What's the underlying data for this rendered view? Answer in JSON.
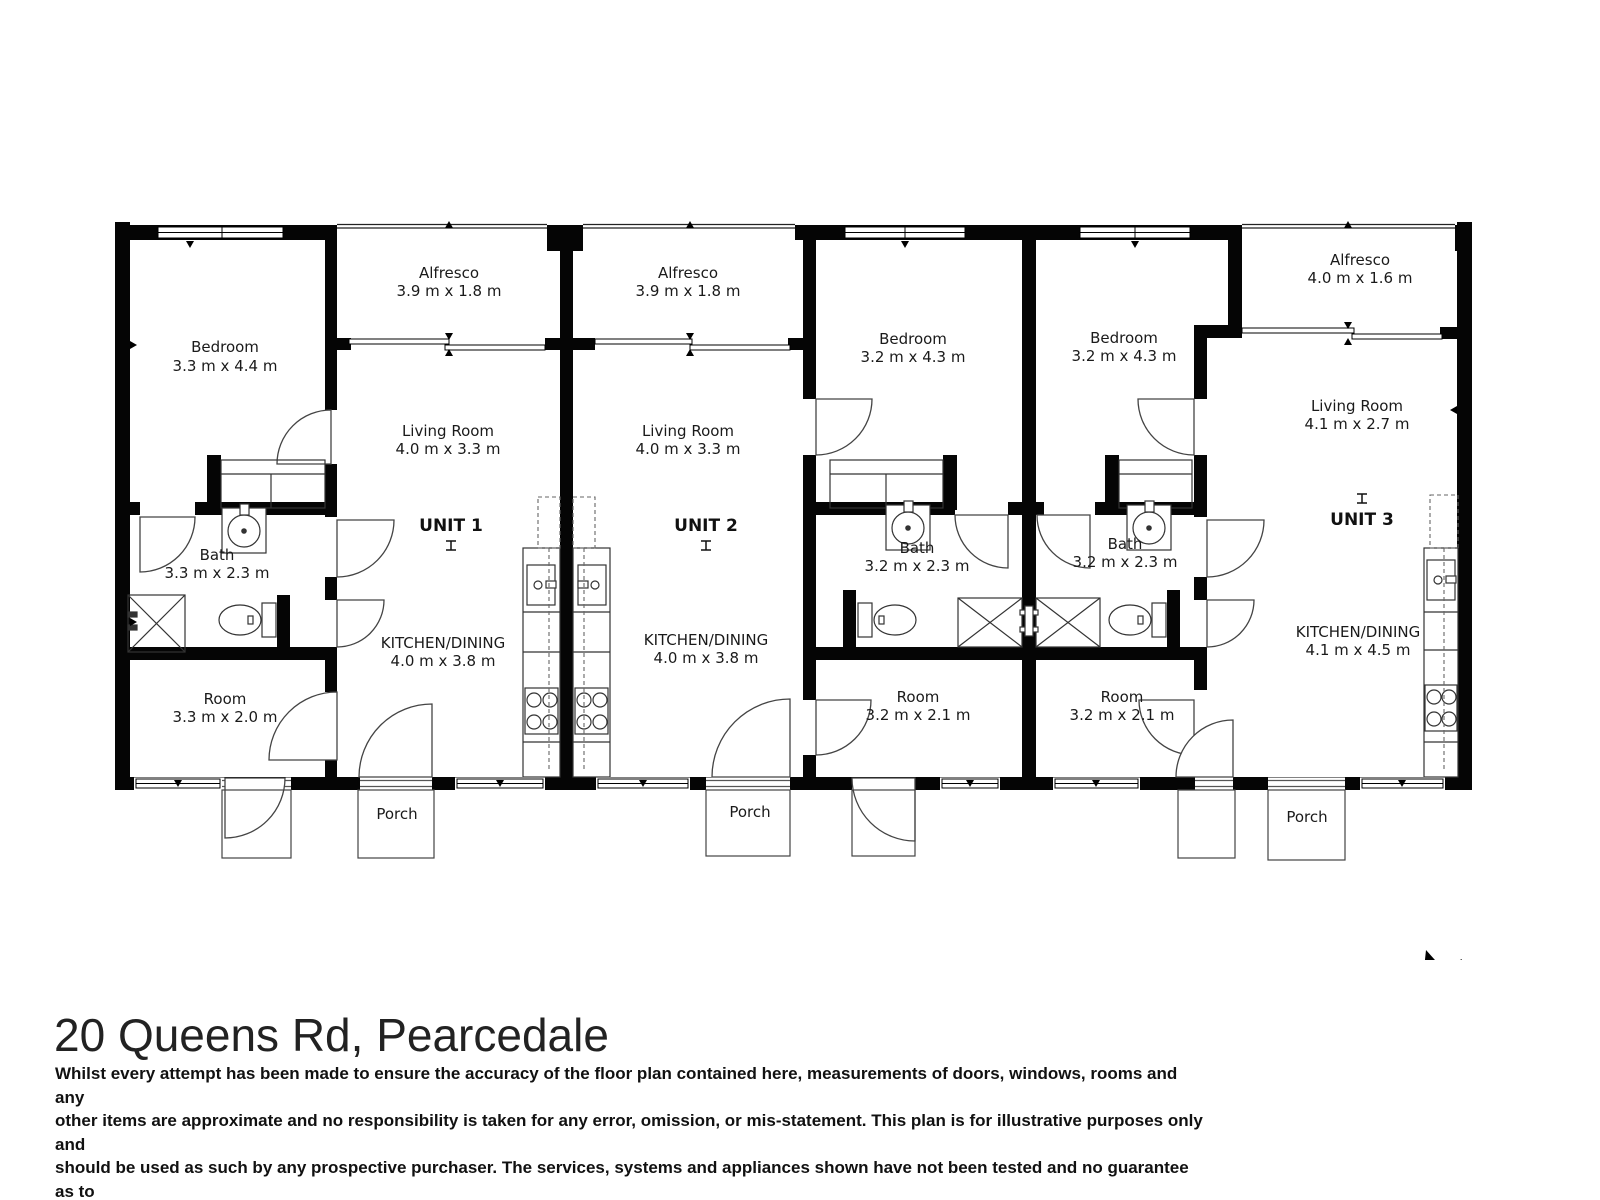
{
  "page_title": "20 Queens Rd, Pearcedale",
  "disclaimer": {
    "lines": [
      "Whilst every attempt has been made to ensure the accuracy of the floor plan contained here, measurements of doors, windows, rooms and any",
      "other items are approximate and no responsibility is taken for any error, omission, or mis-statement. This plan is for illustrative purposes only and",
      "should be used as such by any prospective purchaser. The services, systems and appliances shown have not been tested and no guarantee as to",
      "their operability or efficiency can be given."
    ]
  },
  "north": {
    "label": "N"
  },
  "colors": {
    "walls": "#000000",
    "thin_lines": "#3a3a3a",
    "text": "#1a1a1a"
  },
  "units": [
    {
      "label": "UNIT 1",
      "rooms": {
        "bedroom": {
          "name": "Bedroom",
          "dims": "3.3 m x 4.4 m"
        },
        "alfresco": {
          "name": "Alfresco",
          "dims": "3.9 m x 1.8 m"
        },
        "living": {
          "name": "Living Room",
          "dims": "4.0 m x 3.3 m"
        },
        "bath": {
          "name": "Bath",
          "dims": "3.3 m x 2.3 m"
        },
        "kitchen": {
          "name": "KITCHEN/DINING",
          "dims": "4.0 m x 3.8 m"
        },
        "room": {
          "name": "Room",
          "dims": "3.3 m x 2.0 m"
        },
        "porch": {
          "name": "Porch"
        }
      }
    },
    {
      "label": "UNIT 2",
      "rooms": {
        "alfresco": {
          "name": "Alfresco",
          "dims": "3.9 m x 1.8 m"
        },
        "living": {
          "name": "Living Room",
          "dims": "4.0 m x 3.3 m"
        },
        "bedroom": {
          "name": "Bedroom",
          "dims": "3.2 m x 4.3 m"
        },
        "bath": {
          "name": "Bath",
          "dims": "3.2 m x 2.3 m"
        },
        "kitchen": {
          "name": "KITCHEN/DINING",
          "dims": "4.0 m x 3.8 m"
        },
        "room": {
          "name": "Room",
          "dims": "3.2 m x 2.1 m"
        },
        "porch": {
          "name": "Porch"
        }
      }
    },
    {
      "label": "UNIT 3",
      "rooms": {
        "bedroom": {
          "name": "Bedroom",
          "dims": "3.2 m x 4.3 m"
        },
        "alfresco": {
          "name": "Alfresco",
          "dims": "4.0 m x 1.6 m"
        },
        "living": {
          "name": "Living Room",
          "dims": "4.1 m x 2.7 m"
        },
        "bath": {
          "name": "Bath",
          "dims": "3.2 m x 2.3 m"
        },
        "kitchen": {
          "name": "KITCHEN/DINING",
          "dims": "4.1 m x 4.5 m"
        },
        "room": {
          "name": "Room",
          "dims": "3.2 m x 2.1 m"
        },
        "porch": {
          "name": "Porch"
        }
      }
    }
  ]
}
